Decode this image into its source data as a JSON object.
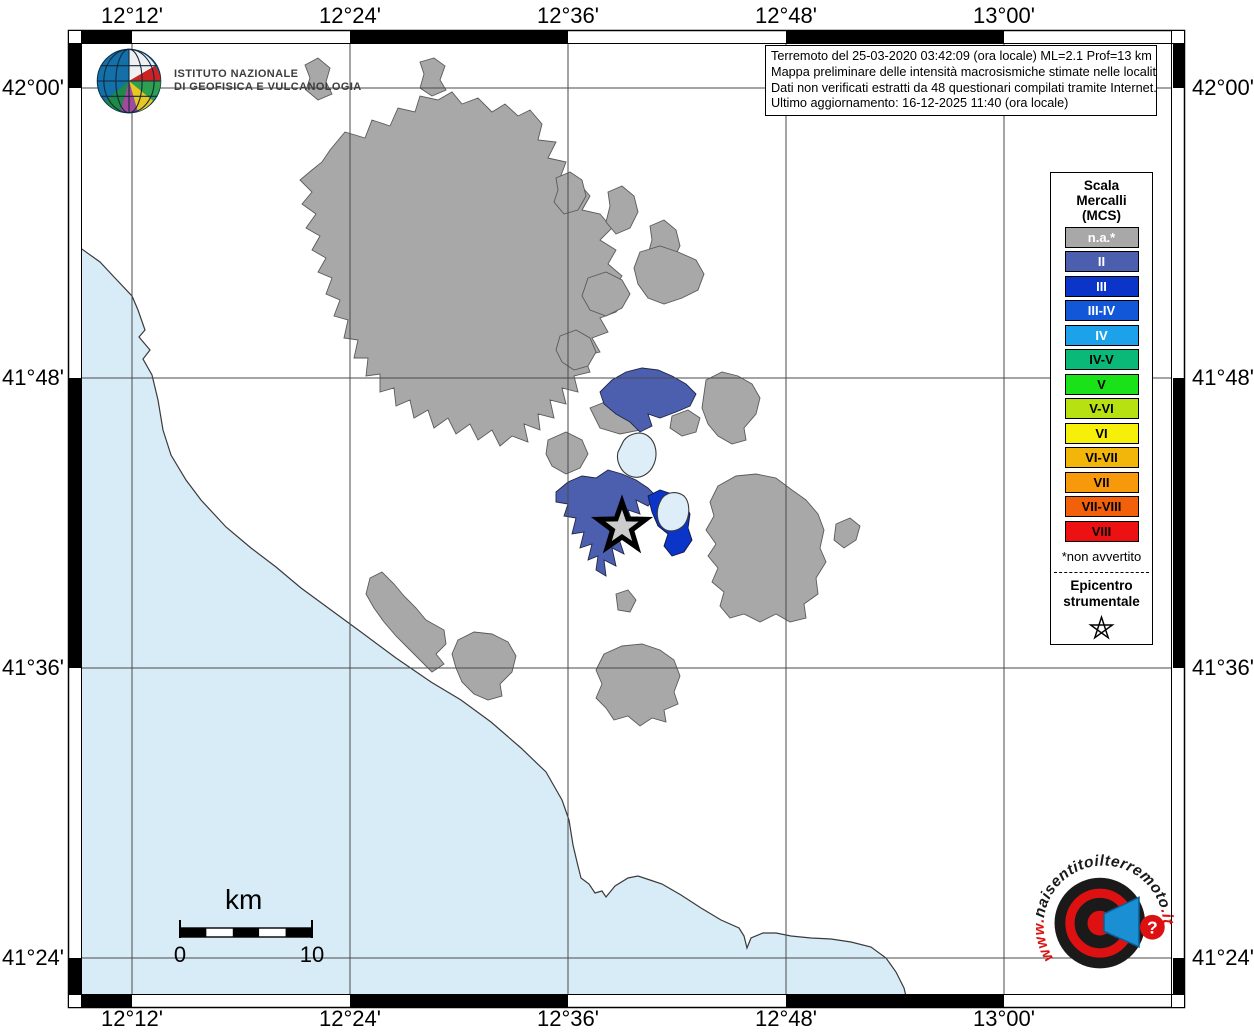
{
  "info_box": {
    "line1": "Terremoto del 25-03-2020 03:42:09 (ora locale) ML=2.1 Prof=13 km",
    "line2": "Mappa preliminare delle intensità macrosismiche stimate nelle località",
    "line3": "Dati non verificati estratti da 48 questionari compilati tramite Internet.",
    "line4": "Ultimo aggiornamento: 16-12-2025 11:40 (ora locale)"
  },
  "ingv_logo": {
    "line1": "ISTITUTO NAZIONALE",
    "line2": "DI GEOFISICA E VULCANOLOGIA"
  },
  "axes": {
    "top": [
      "12°12'",
      "12°24'",
      "12°36'",
      "12°48'",
      "13°00'"
    ],
    "bottom": [
      "12°12'",
      "12°24'",
      "12°36'",
      "12°48'",
      "13°00'"
    ],
    "left": [
      "42°00'",
      "41°48'",
      "41°36'",
      "41°24'"
    ],
    "right": [
      "42°00'",
      "41°48'",
      "41°36'",
      "41°24'"
    ]
  },
  "legend": {
    "title_lines": [
      "Scala",
      "Mercalli",
      "(MCS)"
    ],
    "items": [
      {
        "label": "n.a.*",
        "color": "#a8a8a8",
        "text_color": "#ffffff"
      },
      {
        "label": "II",
        "color": "#4c5fae",
        "text_color": "#ffffff"
      },
      {
        "label": "III",
        "color": "#0b35c8",
        "text_color": "#ffffff"
      },
      {
        "label": "III-IV",
        "color": "#1157d8",
        "text_color": "#ffffff"
      },
      {
        "label": "IV",
        "color": "#1ba2ea",
        "text_color": "#ffffff"
      },
      {
        "label": "IV-V",
        "color": "#0ab878",
        "text_color": "#000000"
      },
      {
        "label": "V",
        "color": "#19e219",
        "text_color": "#000000"
      },
      {
        "label": "V-VI",
        "color": "#b8e112",
        "text_color": "#000000"
      },
      {
        "label": "VI",
        "color": "#f6ef0a",
        "text_color": "#000000"
      },
      {
        "label": "VI-VII",
        "color": "#f2b60a",
        "text_color": "#000000"
      },
      {
        "label": "VII",
        "color": "#f7990a",
        "text_color": "#000000"
      },
      {
        "label": "VII-VIII",
        "color": "#f2610a",
        "text_color": "#000000"
      },
      {
        "label": "VIII",
        "color": "#ee1111",
        "text_color": "#000000"
      }
    ],
    "footnote": "*non avvertito",
    "epicenter_lines": [
      "Epicentro",
      "strumentale"
    ]
  },
  "scale_bar": {
    "unit": "km",
    "start": "0",
    "end": "10"
  },
  "watermark": {
    "www": "www.",
    "name": "haisentitoilterremoto",
    "tld": ".it",
    "question": "?"
  },
  "map": {
    "sea_color": "#d8ecf8",
    "lake_color": "#ddeef8",
    "land_color": "#ffffff",
    "grid_color": "#4a4a4a",
    "epicenter_fill": "#cccccc"
  }
}
